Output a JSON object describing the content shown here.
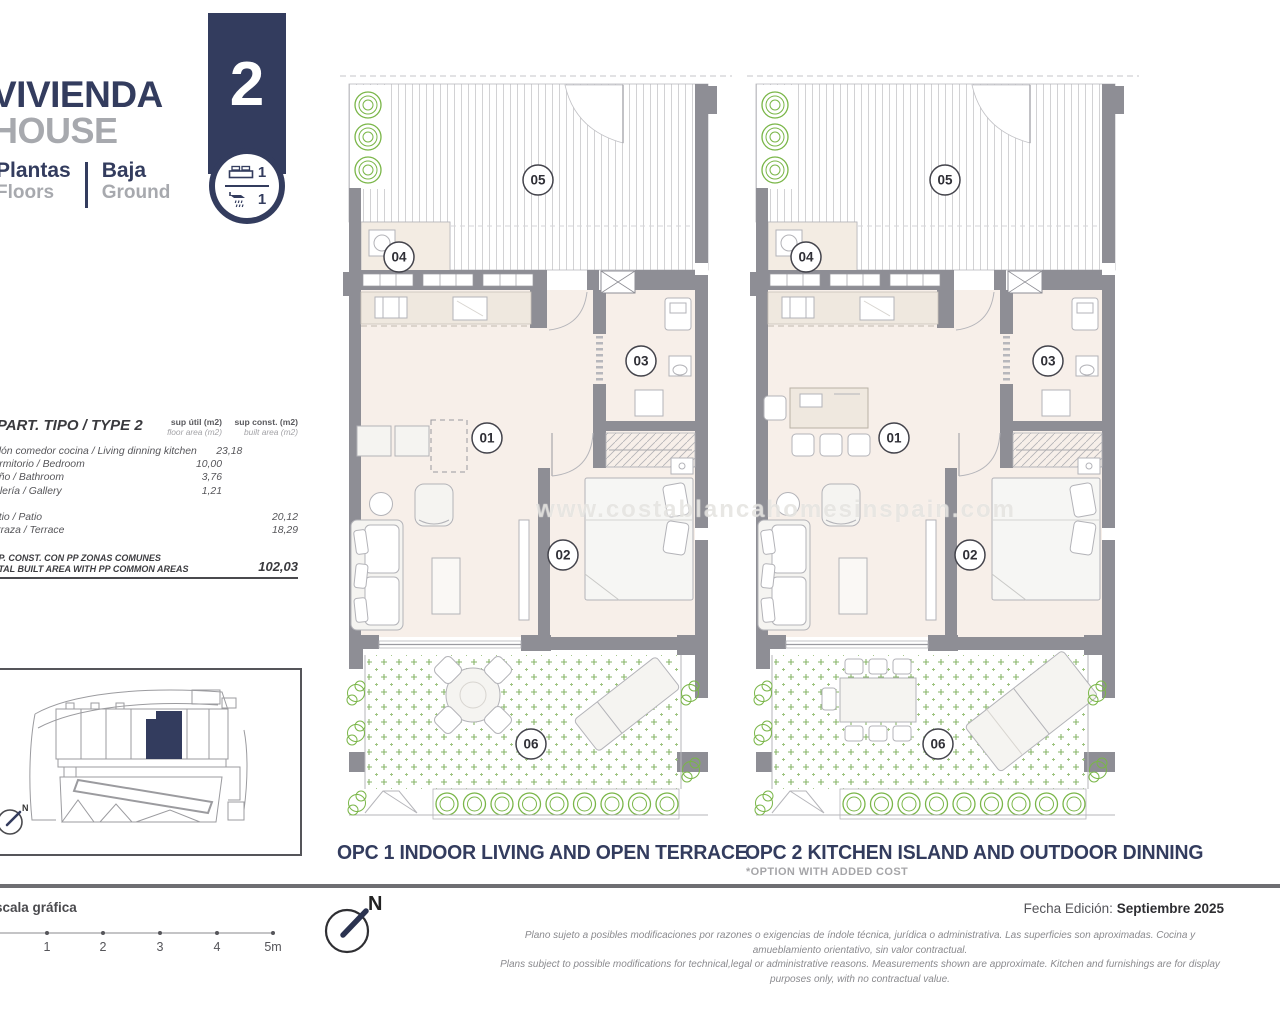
{
  "header": {
    "title_primary": "VIVIENDA",
    "title_secondary": "HOUSE",
    "floors_label_es": "Plantas",
    "floors_label_en": "Floors",
    "floor_value_es": "Baja",
    "floor_value_en": "Ground",
    "unit_number": "2",
    "bedrooms": "1",
    "bathrooms": "1",
    "accent_color": "#333c5e"
  },
  "area_table": {
    "title": "APART. TIPO / TYPE 2",
    "col1_header_line1": "sup útil (m2)",
    "col1_header_line2": "floor area (m2)",
    "col2_header_line1": "sup const. (m2)",
    "col2_header_line2": "built area (m2)",
    "rows": [
      {
        "label": "Salón comedor cocina / Living dinning kitchen",
        "util": "23,18",
        "const": ""
      },
      {
        "label": "Dormitorio / Bedroom",
        "util": "10,00",
        "const": ""
      },
      {
        "label": "Baño / Bathroom",
        "util": "3,76",
        "const": ""
      },
      {
        "label": "Galería / Gallery",
        "util": "1,21",
        "const": ""
      },
      {
        "label": "Patio / Patio",
        "util": "",
        "const": "20,12",
        "spacer_before": true
      },
      {
        "label": "Terraza / Terrace",
        "util": "",
        "const": "18,29"
      }
    ],
    "total_label_line1": "SUP. CONST. CON PP ZONAS COMUNES",
    "total_label_line2": "TOTAL BUILT AREA WITH PP COMMON AREAS",
    "total_value": "102,03"
  },
  "floorplans": {
    "watermark": "www.costablancahomesinspain.com",
    "room_labels": {
      "living": "01",
      "bedroom": "02",
      "bathroom": "03",
      "gallery": "04",
      "terrace": "05",
      "patio": "06"
    },
    "opc1": {
      "caption": "OPC 1 INDOOR LIVING AND OPEN TERRACE"
    },
    "opc2": {
      "caption": "OPC 2 KITCHEN ISLAND AND OUTDOOR DINNING",
      "subcaption": "*OPTION WITH ADDED COST"
    }
  },
  "site_plan": {
    "north_label": "N"
  },
  "footer": {
    "scale_label": "Escala gráfica",
    "scale_ticks": [
      "1",
      "2",
      "3",
      "4",
      "5m"
    ],
    "north_label": "N",
    "edition_label": "Fecha Edición:",
    "edition_value": "Septiembre 2025",
    "disclaimer_es": "Plano sujeto a posibles modificaciones por razones o exigencias de índole técnica,  jurídica o administrativa. Las superficies son aproximadas. Cocina y amueblamiento orientativo, sin valor contractual.",
    "disclaimer_en": "Plans subject to possible modifications for technical,legal or administrative reasons. Measurements shown are approximate. Kitchen and furnishings are for display purposes only, with no contractual value."
  }
}
